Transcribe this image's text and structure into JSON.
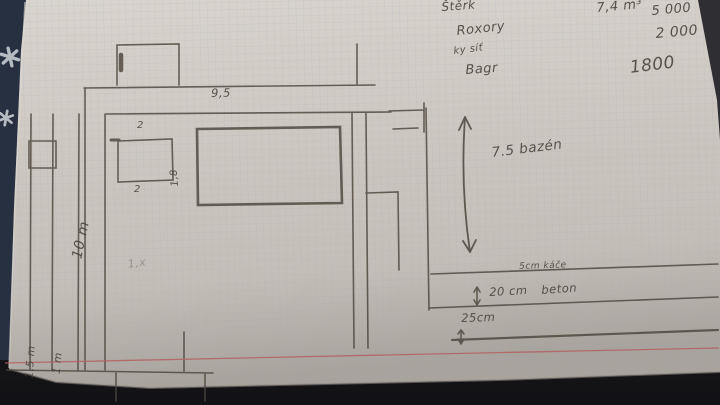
{
  "materials_list": {
    "items": [
      {
        "name": "Štěrk",
        "quantity": "7,4 m³",
        "price": "5 000"
      },
      {
        "name": "Roxory",
        "price": "2 000"
      },
      {
        "name": "ky síť"
      },
      {
        "name": "Bagr",
        "price": "1800"
      }
    ]
  },
  "floor_plan": {
    "top_width_label": "9,5",
    "left_height_label": "10 m",
    "small_room": {
      "top_label": "2",
      "bottom_label": "2",
      "side_label": "1,8"
    },
    "left_columns": {
      "first_label": "1,5 m",
      "second_label": "1 m"
    },
    "faint_note": "1,x"
  },
  "section_detail": {
    "arrow_label": "7.5 bazén",
    "layers": {
      "top": "5cm káče",
      "middle_size": "20 cm",
      "middle_material": "beton",
      "bottom": "25cm"
    }
  },
  "palette": {
    "pencil": "#4a443d",
    "paper": "#cdc7c1",
    "red_margin_line": "#b4605f",
    "background_dark": "#1a1b1f",
    "background_navy": "#273040"
  }
}
